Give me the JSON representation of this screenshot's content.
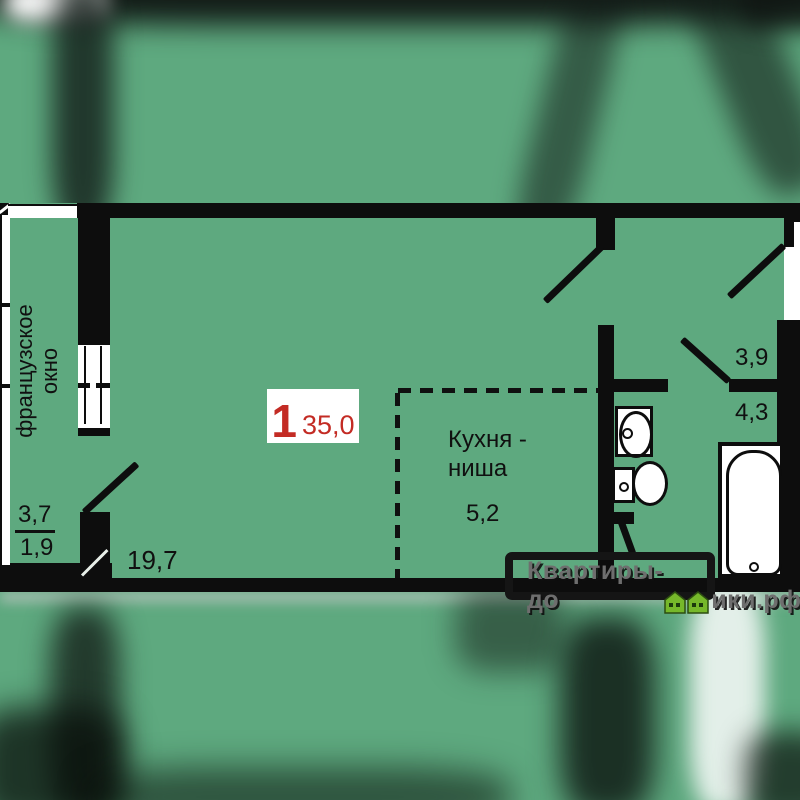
{
  "plan": {
    "unit_number": "1",
    "total_area": "35,0",
    "living_room_area": "19,7",
    "kitchen_label_line1": "Кухня -",
    "kitchen_label_line2": "ниша",
    "kitchen_area": "5,2",
    "hall_area": "3,9",
    "bathroom_area": "4,3",
    "balcony_label_line1": "французское",
    "balcony_label_line2": "окно",
    "balcony_area_total": "3,7",
    "balcony_area_reduced": "1,9"
  },
  "watermark": {
    "text_before_houses": "Квартиры-до",
    "text_after_houses": "ики.рф",
    "full_text": "Квартиры-домики.рф"
  },
  "colors": {
    "plan_background": "#5ea97f",
    "walls": "#0d0d0d",
    "area_accent_red": "#c32b24",
    "watermark_text_gray": "#6e6e6e",
    "watermark_house_green": "#76b82a"
  }
}
